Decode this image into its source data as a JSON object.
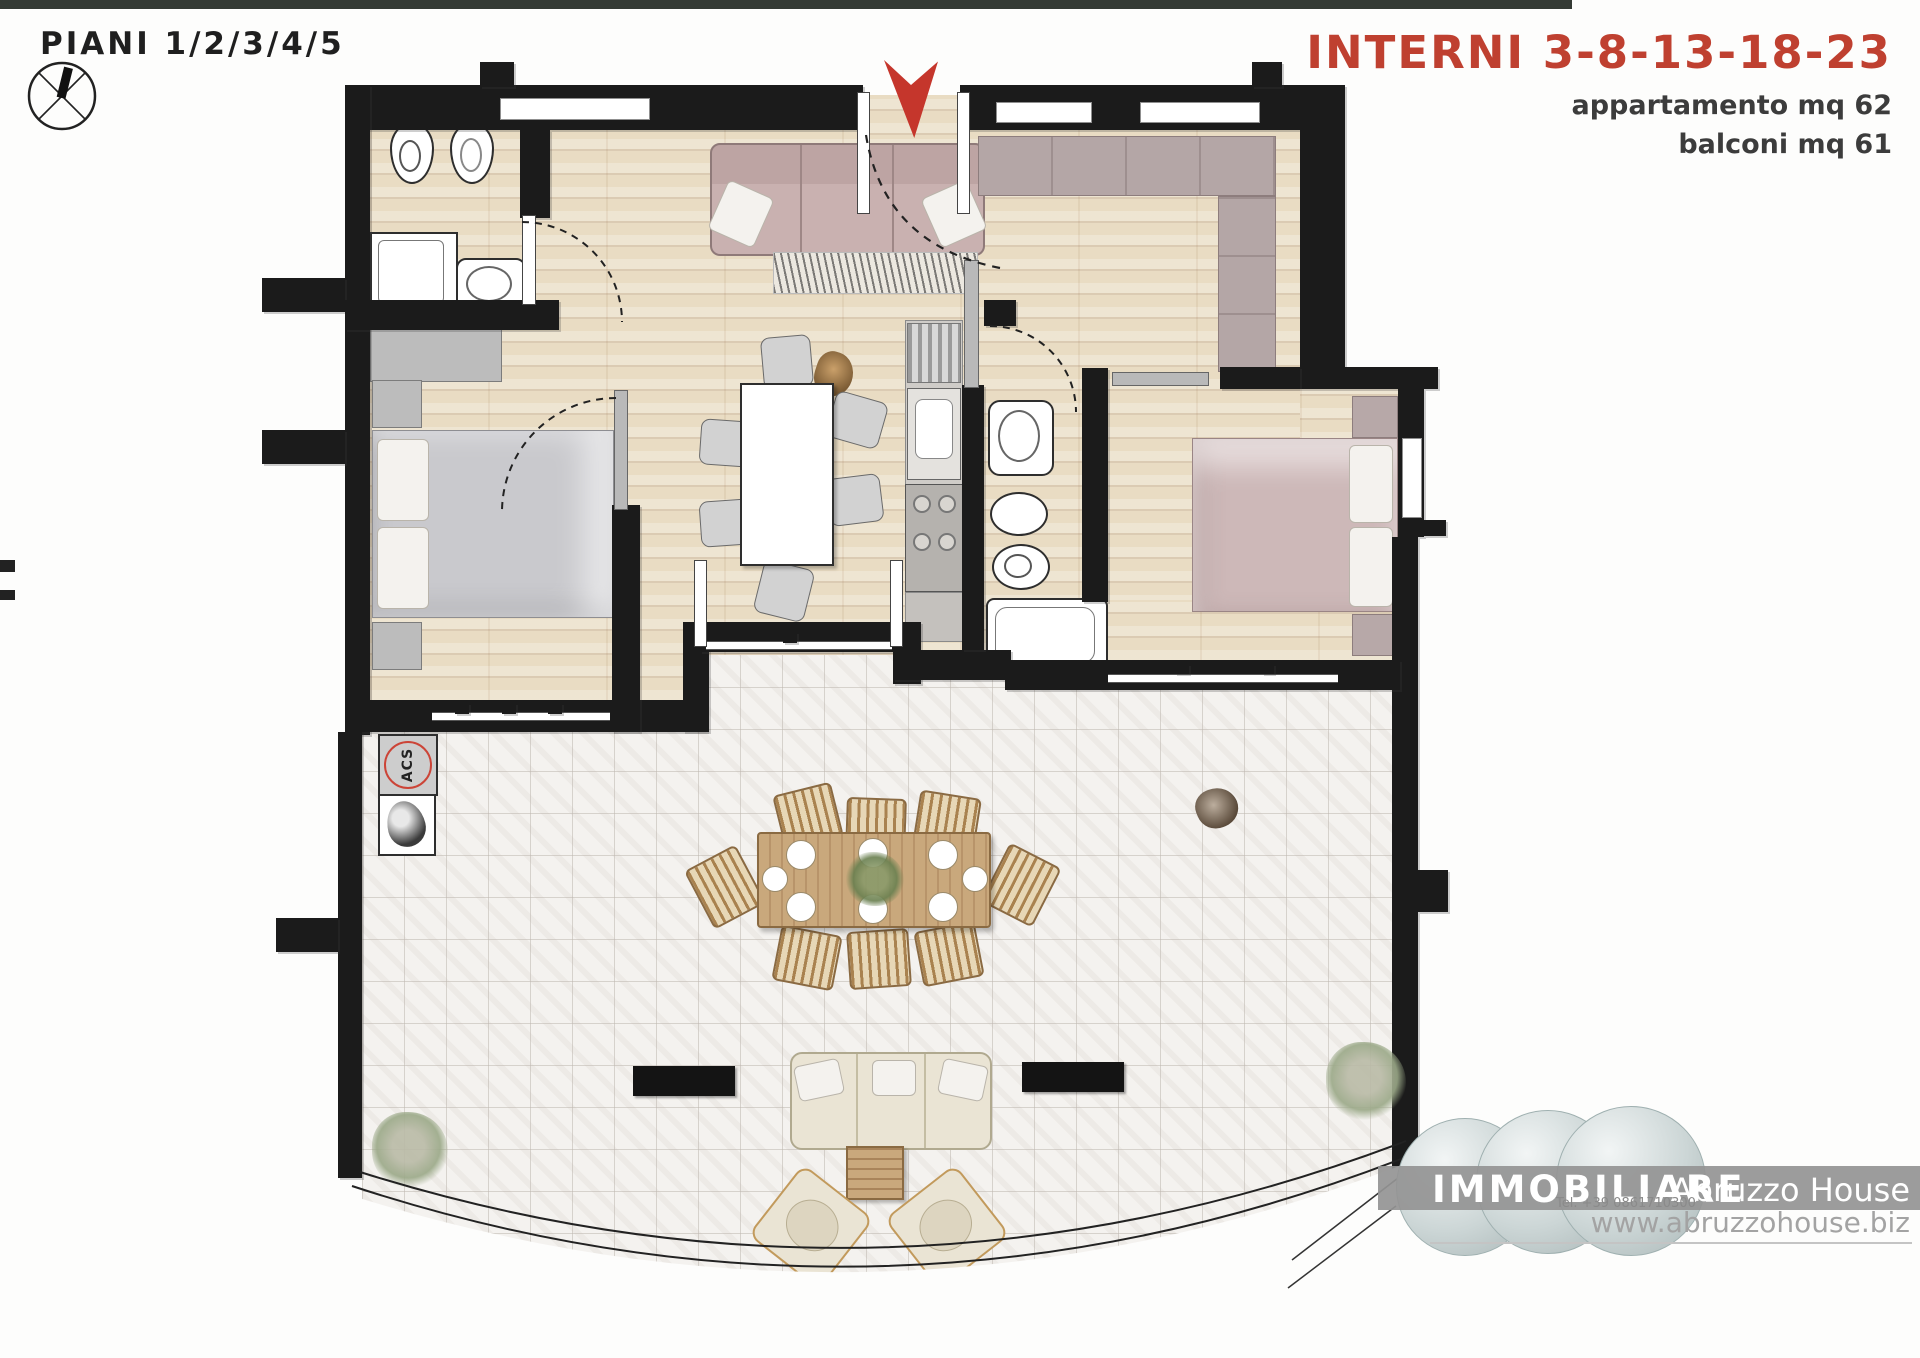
{
  "header": {
    "floors_label": "PIANI 1/2/3/4/5",
    "interni_label": "INTERNI 3-8-13-18-23",
    "apartment_area": "appartamento mq 62",
    "balcony_area": "balconi mq 61"
  },
  "plan": {
    "acs_label": "ACS"
  },
  "footer": {
    "brand": "IMMOBILIARE",
    "agency": "Abruzzo House",
    "phone": "Tel. +39 0861710300",
    "website": "www.abruzzohouse.biz"
  },
  "colors": {
    "accent_red": "#bf4030",
    "entrance_arrow_red": "#c5362c",
    "wall_black": "#1b1b1b",
    "wood_floor": "#e9dcc3",
    "tile_floor": "#f4f2ef",
    "furniture_mauve": "#c6aeae",
    "furniture_gray": "#c6c6ca",
    "outdoor_wood": "#c9a87c",
    "outdoor_cream": "#eae4d4",
    "logo_bar_gray": "#9b9b9b"
  }
}
